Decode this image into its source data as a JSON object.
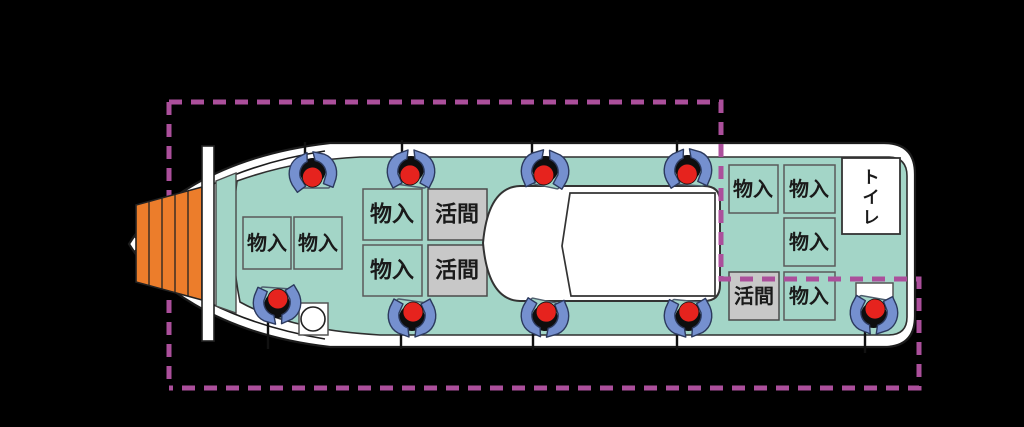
{
  "diagram": {
    "subject": "fishing boat deck plan, top view, with dashed highlight region",
    "labels": {
      "storage": "物入",
      "live_well": "活間",
      "toilet": "トイレ",
      "toilet_chars": [
        "ト",
        "イ",
        "レ"
      ]
    },
    "counts": {
      "storage_boxes": 8,
      "live_well_boxes": 3,
      "toilet_rooms": 1,
      "anglers_top_row": 4,
      "anglers_bottom_row": 5,
      "anglers_total": 9,
      "fishing_rods": 9
    },
    "colors": {
      "background": "#000000",
      "hull": "#ffffff",
      "outline": "#1c1c1c",
      "deck": "#a3d5c7",
      "storage_box_fill": "#a3d5c7",
      "live_well_fill": "#c8c8c8",
      "toilet_fill": "#ffffff",
      "bow_sprit": "#ec7d2b",
      "angler_arms": "#7590cf",
      "angler_head": "#e6231e",
      "highlight_dashed": "#ab4f9b"
    },
    "highlight_region": {
      "style": "magenta dashed stepped rectangle outlining the open fishing deck"
    }
  }
}
